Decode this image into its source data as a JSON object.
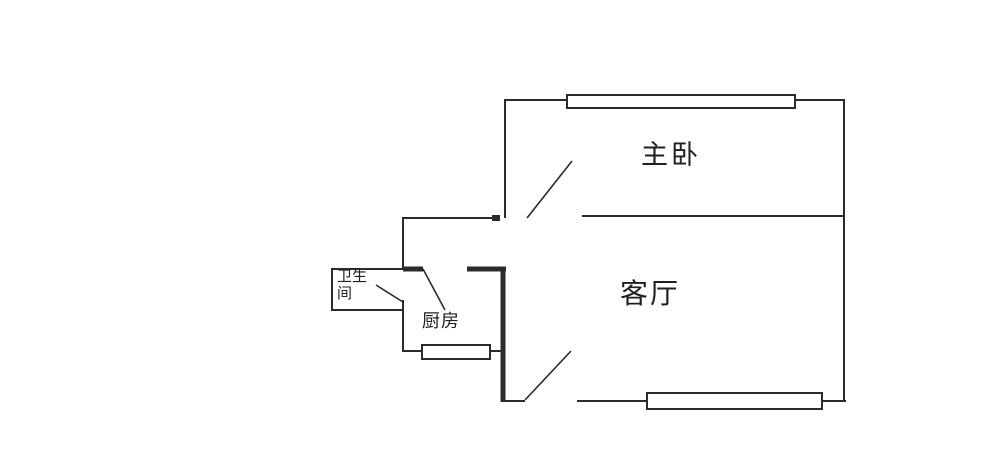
{
  "page": {
    "background_color": "#ffffff",
    "wall_color": "#2b2b2b",
    "text_color": "#1f1f1f"
  },
  "rooms": {
    "master_bedroom": {
      "label": "主卧"
    },
    "living_room": {
      "label": "客厅"
    },
    "kitchen": {
      "label": "厨房"
    },
    "bathroom": {
      "label": "卫生间"
    }
  }
}
